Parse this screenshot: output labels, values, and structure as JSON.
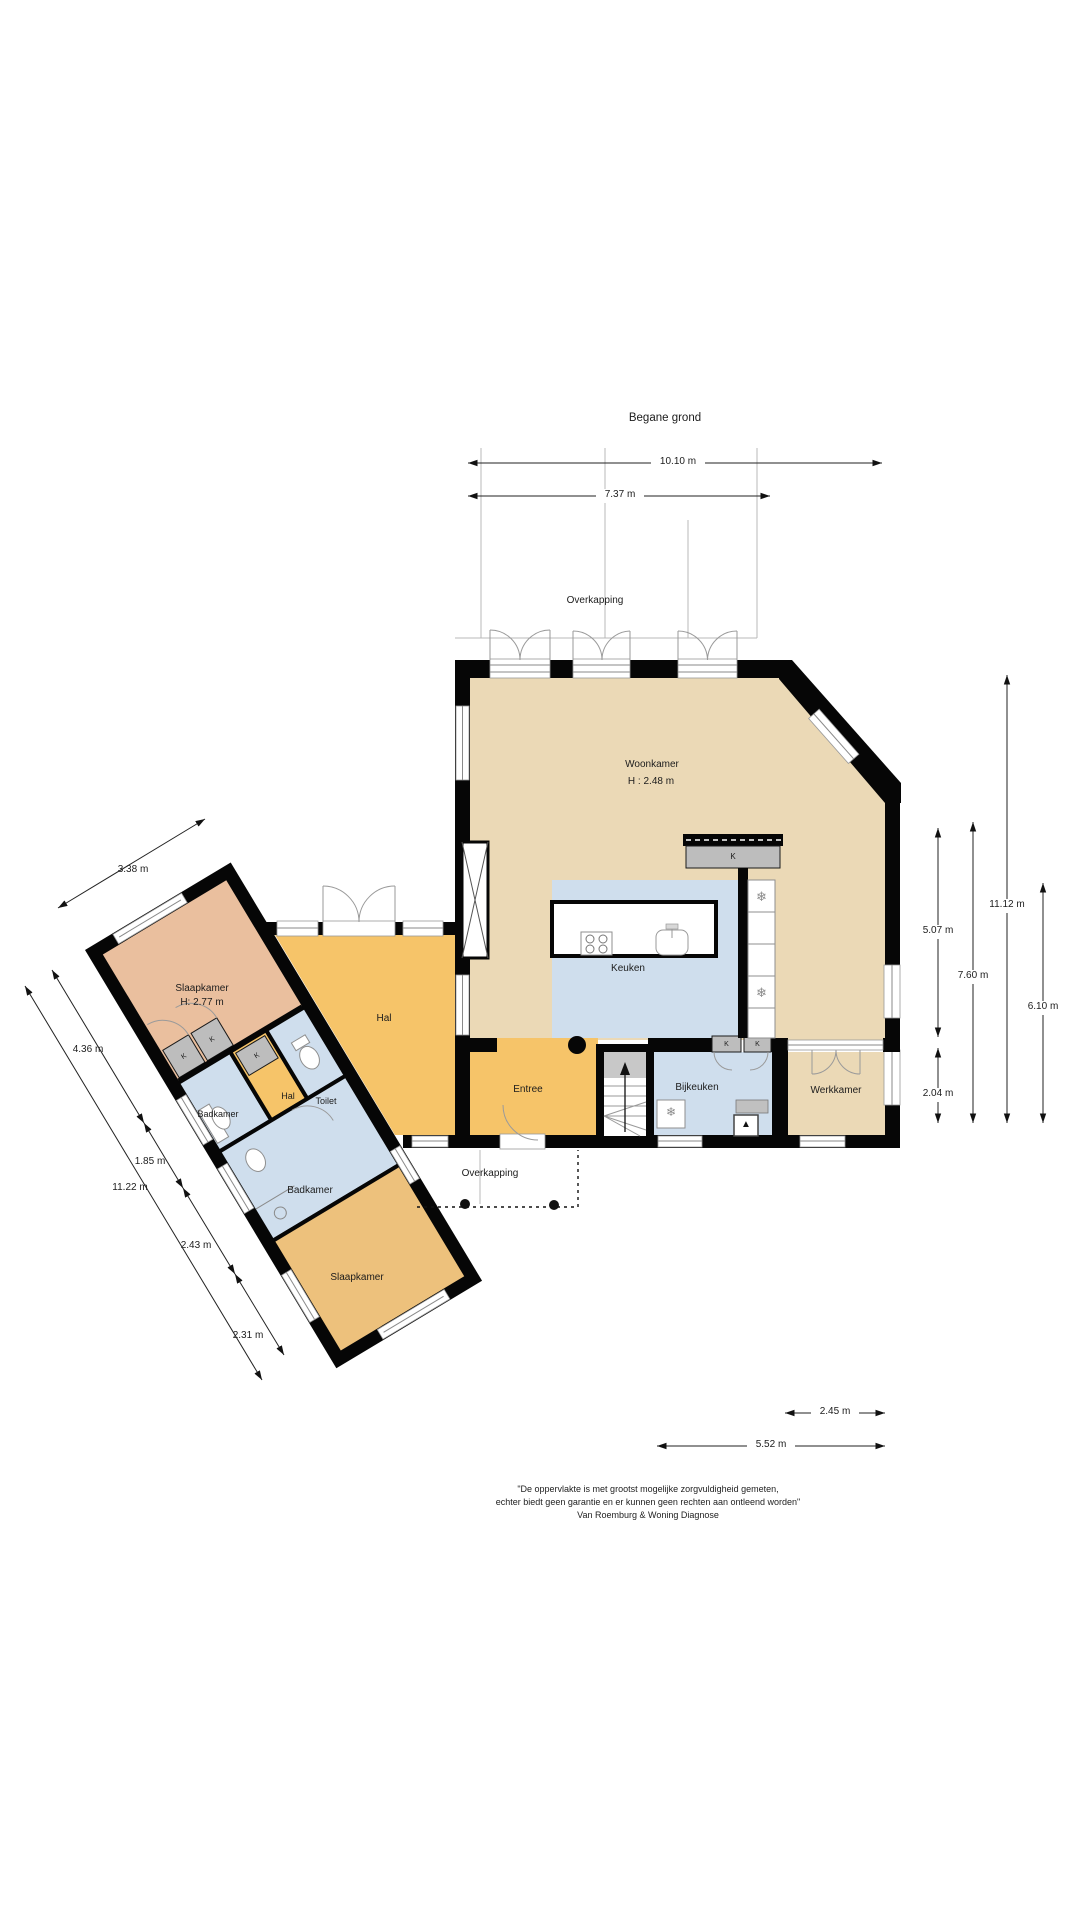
{
  "title": "Begane grond",
  "labels": {
    "k": "K",
    "overkapping_top": "Overkapping",
    "overkapping_bottom": "Overkapping"
  },
  "rooms": {
    "woonkamer": {
      "name": "Woonkamer",
      "height": "H : 2.48 m"
    },
    "keuken": {
      "name": "Keuken"
    },
    "hal": {
      "name": "Hal"
    },
    "entree": {
      "name": "Entree"
    },
    "bijkeuken": {
      "name": "Bijkeuken"
    },
    "werkkamer": {
      "name": "Werkkamer"
    },
    "slaapkamer_boven": {
      "name": "Slaapkamer",
      "height": "H: 2.77 m"
    },
    "badkamer_klein": {
      "name": "Badkamer"
    },
    "hal_klein": {
      "name": "Hal"
    },
    "toilet": {
      "name": "Toilet"
    },
    "badkamer_groot": {
      "name": "Badkamer"
    },
    "slaapkamer_onder": {
      "name": "Slaapkamer"
    }
  },
  "dimensions": {
    "top_outer": "10.10 m",
    "top_inner": "7.37 m",
    "right_wall": "5.07 m",
    "right_lower": "2.04 m",
    "right_mid": "7.60 m",
    "right_outer": "11.12 m",
    "right_inner": "6.10 m",
    "bottom_inner": "2.45 m",
    "bottom_outer": "5.52 m",
    "wing_top": "3.38 m",
    "wing_seg1": "4.36 m",
    "wing_seg2": "1.85 m",
    "wing_total": "11.22 m",
    "wing_seg3": "2.43 m",
    "wing_seg4": "2.31 m"
  },
  "footer": {
    "line1": "\"De oppervlakte is met grootst mogelijke zorgvuldigheid gemeten,",
    "line2": "echter biedt geen garantie en er kunnen geen rechten aan ontleend worden\"",
    "line3": "Van Roemburg & Woning Diagnose"
  },
  "colors": {
    "living": "#ebd9b6",
    "hall_orange": "#f6c469",
    "wet_blue": "#cfdeed",
    "bedroom_salmon": "#eabf9e",
    "bedroom_tan": "#edc17c",
    "closet_gray": "#bdbdbd",
    "wall": "#060606"
  }
}
